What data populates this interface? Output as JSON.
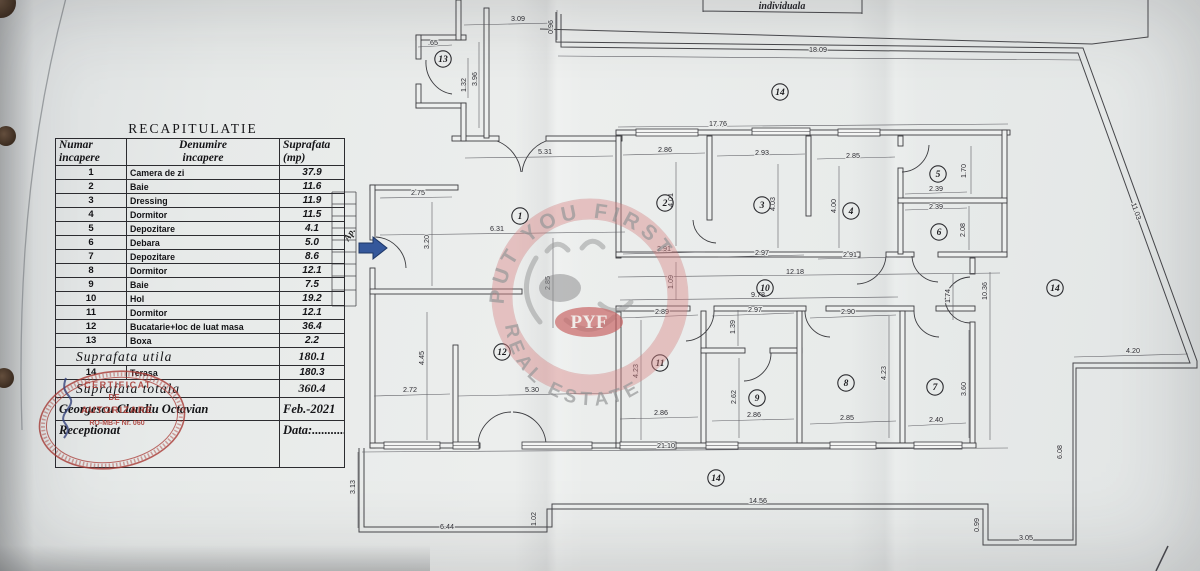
{
  "title_block": {
    "label": "individuala"
  },
  "table": {
    "title": "RECAPITULATIE",
    "headers": [
      "Numar\nincapere",
      "Denumire\nincapere",
      "Suprafata\n(mp)"
    ],
    "rows": [
      [
        "1",
        "Camera de zi",
        "37.9"
      ],
      [
        "2",
        "Baie",
        "11.6"
      ],
      [
        "3",
        "Dressing",
        "11.9"
      ],
      [
        "4",
        "Dormitor",
        "11.5"
      ],
      [
        "5",
        "Depozitare",
        "4.1"
      ],
      [
        "6",
        "Debara",
        "5.0"
      ],
      [
        "7",
        "Depozitare",
        "8.6"
      ],
      [
        "8",
        "Dormitor",
        "12.1"
      ],
      [
        "9",
        "Baie",
        "7.5"
      ],
      [
        "10",
        "Hol",
        "19.2"
      ],
      [
        "11",
        "Dormitor",
        "12.1"
      ],
      [
        "12",
        "Bucatarie+loc de luat masa",
        "36.4"
      ],
      [
        "13",
        "Boxa",
        "2.2"
      ]
    ],
    "summary_rows": [
      {
        "label": "Suprafata  utila",
        "value": "180.1"
      },
      {
        "num": "14",
        "label": "Terasa",
        "value": "180.3"
      },
      {
        "label": "Suprafata  totala",
        "value": "360.4"
      }
    ],
    "signature_row": {
      "name": "Georgescu  Claudiu  Octavian",
      "date": "Feb.-2021"
    },
    "reception_row": {
      "label": "Receptionat",
      "value": "Data:..........."
    }
  },
  "stamp": {
    "line1": "CERTIFICAT",
    "line2": "DE",
    "line3": "AUTORIZARE",
    "line4": "RO-MB-F Nr. 060"
  },
  "watermark": {
    "arc_top": "PUT YOU FIRST",
    "arc_bottom": "REAL ESTATE",
    "center": "PYF"
  },
  "plan": {
    "entrance_label": "Ap.",
    "rooms": [
      [
        "1",
        520,
        216
      ],
      [
        "2",
        665,
        203
      ],
      [
        "3",
        762,
        205
      ],
      [
        "4",
        851,
        211
      ],
      [
        "5",
        938,
        174
      ],
      [
        "6",
        939,
        232
      ],
      [
        "7",
        935,
        387
      ],
      [
        "8",
        846,
        383
      ],
      [
        "9",
        757,
        398
      ],
      [
        "10",
        765,
        288
      ],
      [
        "11",
        660,
        363
      ],
      [
        "12",
        502,
        352
      ],
      [
        "13",
        443,
        59
      ],
      [
        "14",
        780,
        92
      ],
      [
        "14",
        1055,
        288
      ],
      [
        "14",
        716,
        478
      ]
    ],
    "dims": [
      [
        ".65",
        433,
        45,
        0
      ],
      [
        "1.32",
        466,
        85,
        -90
      ],
      [
        "3.96",
        477,
        79,
        -90
      ],
      [
        "3.09",
        518,
        21,
        0
      ],
      [
        "0.96",
        553,
        27,
        -90
      ],
      [
        "18.09",
        818,
        52,
        0
      ],
      [
        "17.76",
        718,
        126,
        0
      ],
      [
        "5.31",
        545,
        154,
        0
      ],
      [
        "2.86",
        665,
        152,
        0
      ],
      [
        "2.93",
        762,
        155,
        0
      ],
      [
        "2.85",
        853,
        158,
        0
      ],
      [
        "2.39",
        936,
        191,
        0
      ],
      [
        "2.39",
        936,
        209,
        0
      ],
      [
        "1.70",
        966,
        171,
        -90
      ],
      [
        "2.08",
        965,
        230,
        -90
      ],
      [
        "4.01",
        673,
        200,
        -90
      ],
      [
        "4.03",
        775,
        204,
        -90
      ],
      [
        "4.00",
        836,
        206,
        -90
      ],
      [
        "2.91",
        664,
        251,
        0
      ],
      [
        "2.97",
        762,
        255,
        0
      ],
      [
        "2.91",
        850,
        257,
        0
      ],
      [
        "2.75",
        418,
        195,
        0
      ],
      [
        "3.20",
        429,
        242,
        -90
      ],
      [
        "6.31",
        497,
        231,
        0
      ],
      [
        "2.85",
        550,
        283,
        -90
      ],
      [
        "12.18",
        795,
        274,
        0
      ],
      [
        "9.78",
        758,
        297,
        0
      ],
      [
        "1.09",
        673,
        282,
        -90
      ],
      [
        "1.74",
        950,
        296,
        -90
      ],
      [
        "10.36",
        987,
        291,
        -90
      ],
      [
        "11.03",
        1134,
        212,
        71
      ],
      [
        "2.89",
        662,
        314,
        0
      ],
      [
        "2.97",
        755,
        312,
        0
      ],
      [
        "2.90",
        848,
        314,
        0
      ],
      [
        "1.39",
        735,
        327,
        -90
      ],
      [
        "4.23",
        638,
        371,
        -90
      ],
      [
        "2.62",
        736,
        397,
        -90
      ],
      [
        "4.23",
        886,
        373,
        -90
      ],
      [
        "3.60",
        966,
        389,
        -90
      ],
      [
        "4.45",
        424,
        358,
        -90
      ],
      [
        "2.72",
        410,
        392,
        0
      ],
      [
        "5.30",
        532,
        392,
        0
      ],
      [
        "2.86",
        661,
        415,
        0
      ],
      [
        "2.86",
        754,
        417,
        0
      ],
      [
        "2.85",
        847,
        420,
        0
      ],
      [
        "2.40",
        936,
        422,
        0
      ],
      [
        "21.10",
        666,
        448,
        0
      ],
      [
        "3.13",
        355,
        487,
        -90
      ],
      [
        "6.44",
        447,
        529,
        0
      ],
      [
        "1.02",
        536,
        519,
        -90
      ],
      [
        "14.56",
        758,
        503,
        0
      ],
      [
        "0.99",
        979,
        525,
        -90
      ],
      [
        "3.05",
        1026,
        540,
        0
      ],
      [
        "6.08",
        1062,
        452,
        -90
      ],
      [
        "4.20",
        1133,
        353,
        0
      ]
    ]
  }
}
